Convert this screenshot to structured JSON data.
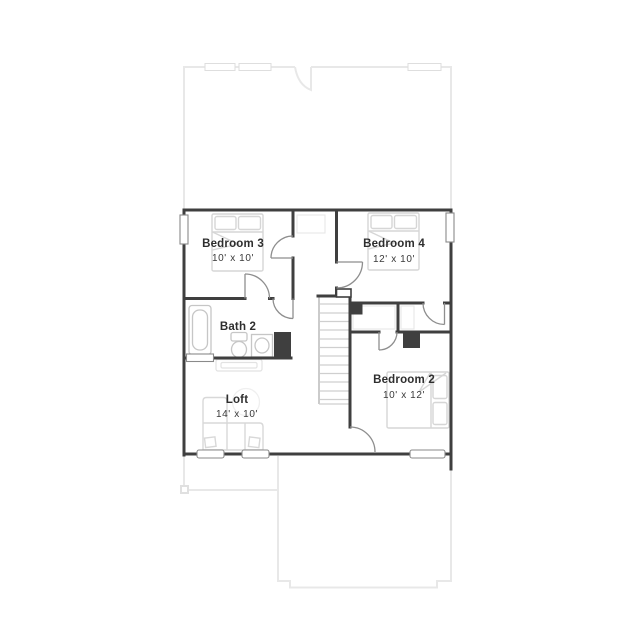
{
  "floor_plan": {
    "rooms": [
      {
        "name": "Bedroom 3",
        "dimensions": "10' x 10'"
      },
      {
        "name": "Bedroom 4",
        "dimensions": "12' x 10'"
      },
      {
        "name": "Bath 2",
        "dimensions": ""
      },
      {
        "name": "Loft",
        "dimensions": "14' x 10'"
      },
      {
        "name": "Bedroom 2",
        "dimensions": "10' x 12'"
      }
    ],
    "fixtures": [
      "bed",
      "bed",
      "bed",
      "bathtub",
      "toilet",
      "sink-vanity",
      "sectional-sofa",
      "console-table",
      "rug",
      "stairs",
      "closet"
    ],
    "colors": {
      "wall": "#3f3f3f",
      "door_swing": "#8e8e8e",
      "furniture_line": "#d6d6d6",
      "fixture_line": "#c6c6c6",
      "faint_outline": "#e8e8e8",
      "label_text": "#2e2e2e",
      "background": "#ffffff"
    }
  }
}
